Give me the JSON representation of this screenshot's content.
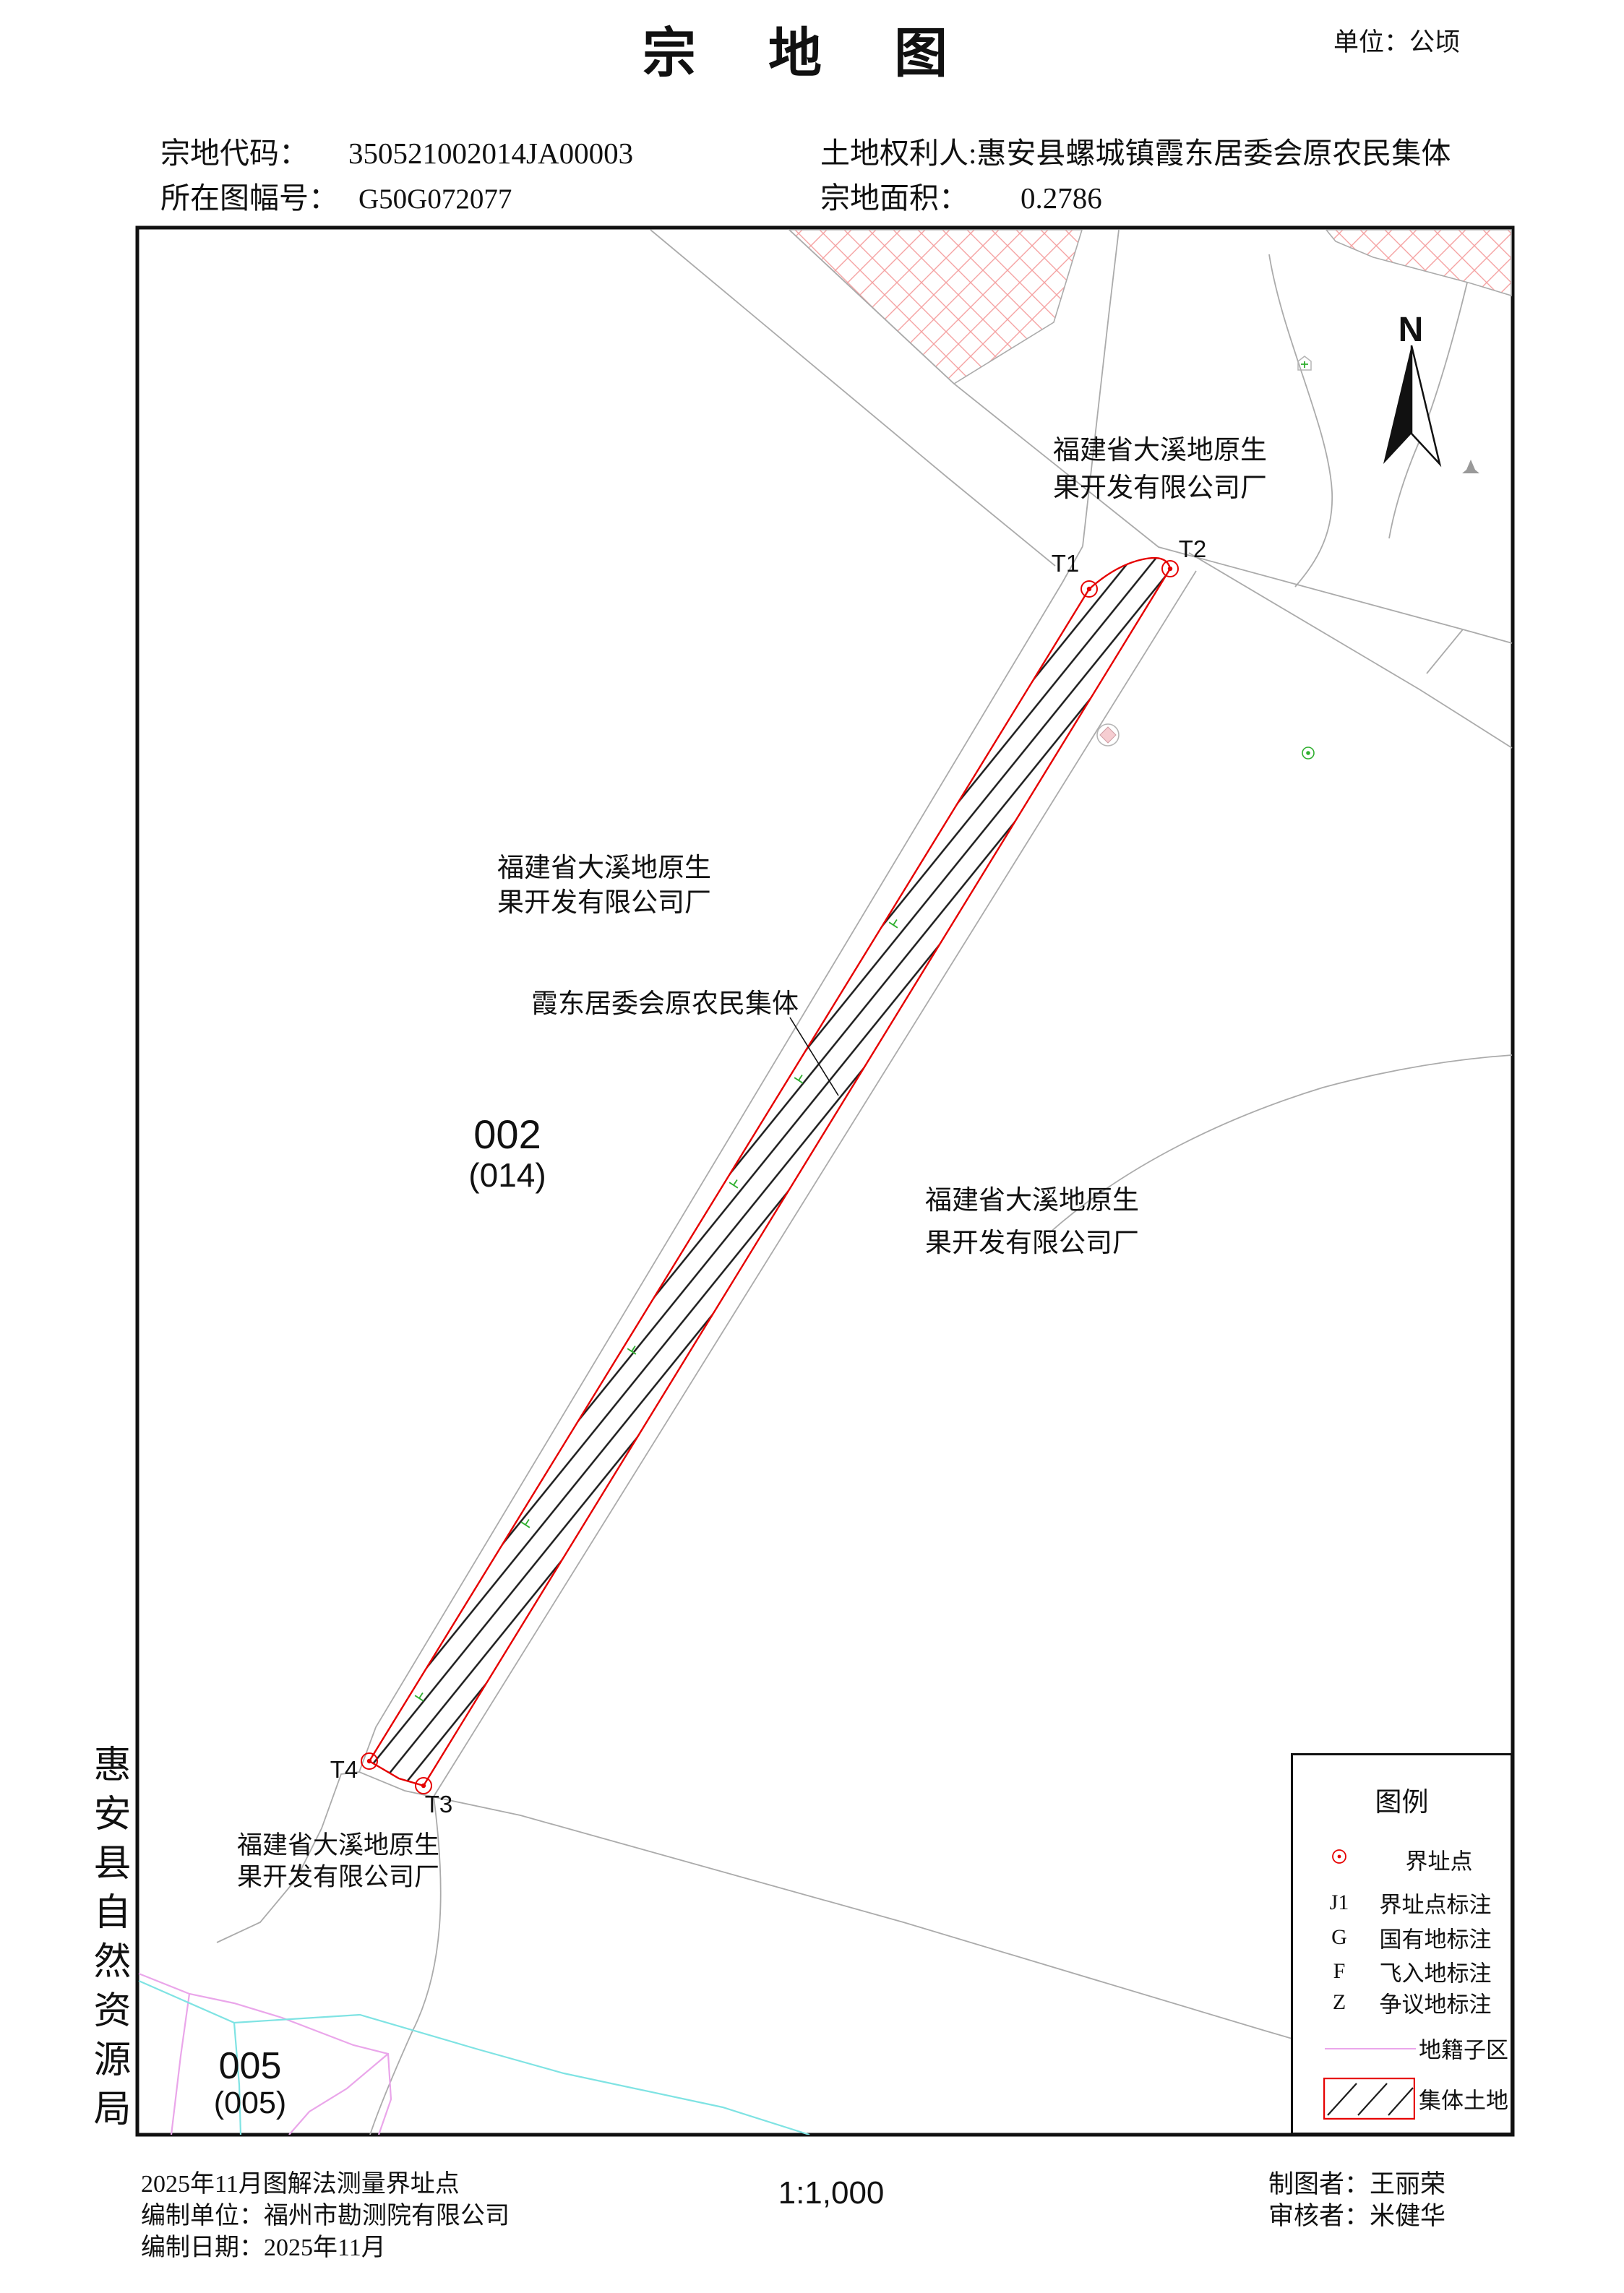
{
  "header": {
    "title": "宗地图",
    "unit_label": "单位：公顷",
    "parcel_code_label": "宗地代码：",
    "parcel_code": "350521002014JA00003",
    "sheet_label": "所在图幅号：",
    "sheet_no": "G50G072077",
    "holder_label": "土地权利人:",
    "holder": "惠安县螺城镇霞东居委会原农民集体",
    "area_label": "宗地面积：",
    "area": "0.2786"
  },
  "map": {
    "north_label": "N",
    "company": [
      "福建省大溪地原生",
      "果开发有限公司厂"
    ],
    "collective_label": "霞东居委会原农民集体",
    "parcel_002": "002",
    "parcel_002_sub": "(014)",
    "parcel_005": "005",
    "parcel_005_sub": "(005)",
    "markers": {
      "t1": "T1",
      "t2": "T2",
      "t3": "T3",
      "t4": "T4"
    }
  },
  "legend": {
    "title": "图例",
    "items": [
      {
        "symbol": "boundary-point-dot",
        "text": "",
        "label": "界址点"
      },
      {
        "symbol": "letter",
        "text": "J1",
        "label": "界址点标注"
      },
      {
        "symbol": "letter",
        "text": "G",
        "label": "国有地标注"
      },
      {
        "symbol": "letter",
        "text": "F",
        "label": "飞入地标注"
      },
      {
        "symbol": "letter",
        "text": "Z",
        "label": "争议地标注"
      },
      {
        "symbol": "subzone-line",
        "text": "",
        "label": "地籍子区"
      },
      {
        "symbol": "collective-hatch",
        "text": "",
        "label": "集体土地"
      }
    ]
  },
  "footer": {
    "note1": "2025年11月图解法测量界址点",
    "note2": "编制单位：福州市勘测院有限公司",
    "note3": "编制日期：2025年11月",
    "scale": "1:1,000",
    "drafter": "制图者：王丽荣",
    "reviewer": "审核者：米健华"
  },
  "side": {
    "agency": "惠安县自然资源局"
  },
  "colors": {
    "ink": "#111111",
    "red": "#e60000",
    "xhatch": "#f5a2a2",
    "gray": "#ababab",
    "violet": "#eaa6ea",
    "cyan": "#7fe3e3",
    "green": "#2faf2f",
    "paper": "#ffffff"
  }
}
